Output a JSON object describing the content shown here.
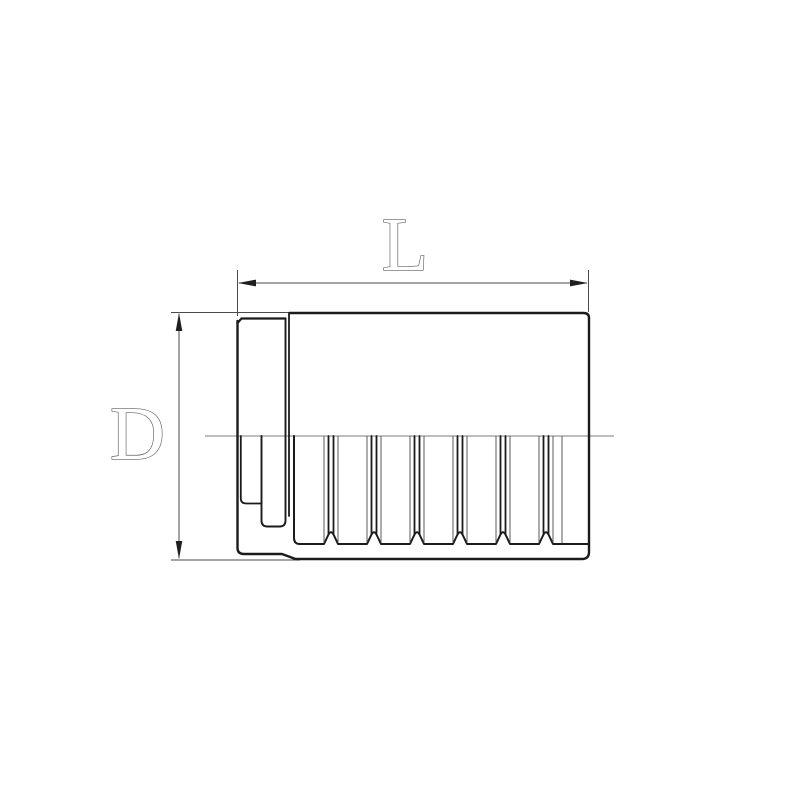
{
  "drawing": {
    "kind": "ferrule-cross-section",
    "labels": {
      "length_dimension": "L",
      "diameter_dimension": "D"
    },
    "colors": {
      "background": "#ffffff",
      "outline_dark": "#1b1b1b",
      "thin_line": "#5a5a5a",
      "centerline": "#7d7d7d",
      "dimension_line": "#4a4a4a",
      "arrowhead": "#1f1f1f",
      "label_fill": "#ffffff",
      "label_outline": "#5f5f5f"
    }
  }
}
